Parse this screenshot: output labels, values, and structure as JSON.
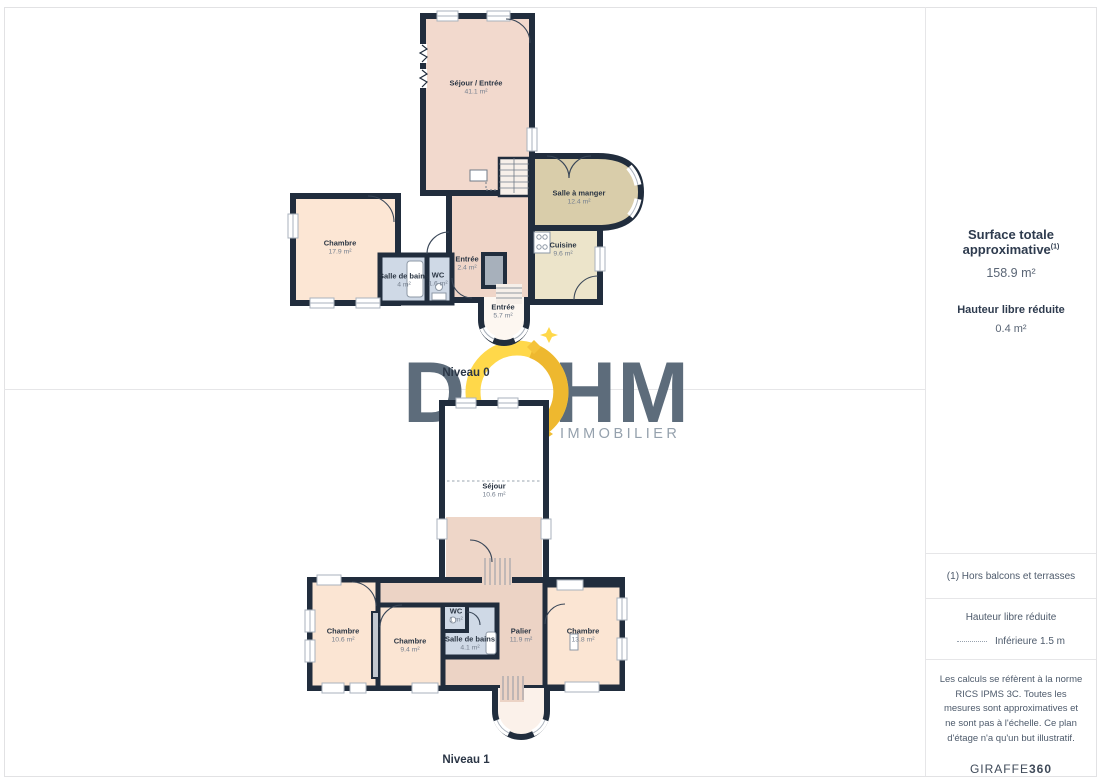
{
  "logo": {
    "letter_d": "D",
    "letters_hm": "HM",
    "tagline": "IMMOBILIER"
  },
  "floors": {
    "niveau0": {
      "label": "Niveau 0",
      "rooms": {
        "sejour_entree": {
          "name": "Séjour / Entrée",
          "area": "41.1 m²"
        },
        "salle_a_manger": {
          "name": "Salle à manger",
          "area": "12.4 m²"
        },
        "cuisine": {
          "name": "Cuisine",
          "area": "9.6 m²"
        },
        "chambre": {
          "name": "Chambre",
          "area": "17.9 m²"
        },
        "salle_de_bains": {
          "name": "Salle de bains",
          "area": "4 m²"
        },
        "wc": {
          "name": "WC",
          "area": "1.6 m²"
        },
        "entree": {
          "name": "Entrée",
          "area": "2.4 m²"
        },
        "entree_tour": {
          "name": "Entrée",
          "area": "5.7 m²"
        }
      }
    },
    "niveau1": {
      "label": "Niveau 1",
      "rooms": {
        "sejour": {
          "name": "Séjour",
          "area": "10.6 m²"
        },
        "chambre_ouest": {
          "name": "Chambre",
          "area": "10.6 m²"
        },
        "chambre_centre": {
          "name": "Chambre",
          "area": "9.4 m²"
        },
        "wc": {
          "name": "WC",
          "area": "1 m²"
        },
        "salle_de_bains": {
          "name": "Salle de bains",
          "area": "4.1 m²"
        },
        "palier": {
          "name": "Palier",
          "area": "11.9 m²"
        },
        "chambre_est": {
          "name": "Chambre",
          "area": "13.8 m²"
        }
      }
    }
  },
  "sidebar": {
    "summary": {
      "title": "Surface totale approximative",
      "title_sup": "(1)",
      "total_area": "158.9 m²",
      "reduced_title": "Hauteur libre réduite",
      "reduced_area": "0.4 m²"
    },
    "footnote": "(1) Hors balcons et terrasses",
    "legend": {
      "title": "Hauteur libre réduite",
      "item": "Inférieure 1.5 m"
    },
    "disclaimer": "Les calculs se réfèrent à la norme RICS IPMS 3C. Toutes les mesures sont approximatives et ne sont pas à l'échelle. Ce plan d'étage n'a qu'un but illustratif.",
    "credit": {
      "brand": "GIRAFFE",
      "suffix": "360"
    }
  },
  "colors": {
    "wall": "#212d3d",
    "accent_yellow": "#ffd84a",
    "accent_gold": "#eeb82f",
    "logo_slate": "#5d6c7b"
  }
}
